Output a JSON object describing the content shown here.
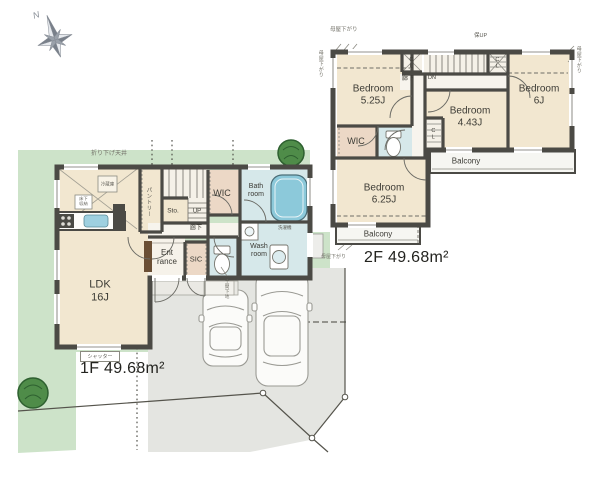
{
  "compass": {
    "north": "N"
  },
  "floor1": {
    "area_label": "1F 49.68m²",
    "rooms": {
      "ldk": "LDK\n16J",
      "pantry": "パントリー",
      "storage": "Sto.",
      "stairs_up": "UP",
      "hallway": "廊下",
      "wic": "WIC",
      "bathroom": "Bath\nroom",
      "washroom": "Wash\nroom",
      "entrance": "Ent\nrance",
      "shoe_closet": "SIC"
    },
    "annotations": {
      "dropped_ceiling": "折り下げ天井",
      "refrigerator": "冷蔵庫",
      "underfloor_storage": "床下収納",
      "washing_machine": "洗濯機",
      "shutter": "シャッター",
      "porch_note": "土間下地"
    }
  },
  "floor2": {
    "area_label": "2F 49.68m²",
    "rooms": {
      "bedroom_525": "Bedroom\n5.25J",
      "bedroom_6": "Bedroom\n6J",
      "bedroom_443": "Bedroom\n4.43J",
      "bedroom_625": "Bedroom\n6.25J",
      "wic": "WIC",
      "closet_a": "CL",
      "closet_b": "CL",
      "closet_c": "CL",
      "stairs_down": "DN",
      "stairs_attic": "保UP",
      "hallway": "廊下",
      "balcony_side": "Balcony",
      "balcony_main": "Balcony"
    },
    "annotations": {
      "eaves_top": "母屋下がり",
      "eaves_left": "母屋下がり",
      "eaves_right": "母屋下がり",
      "eaves_bottom": "母屋下がり"
    }
  },
  "colors": {
    "site_green": "#cde3c9",
    "tree_green": "#4f8c49",
    "driveway_gray": "#e4e5e1",
    "room_beige": "#f2e7d0",
    "closet_pink": "#ecd8c6",
    "wet_blue": "#d6e8ea",
    "tub_blue": "#85c7d9",
    "wall": "#4b4a45"
  }
}
